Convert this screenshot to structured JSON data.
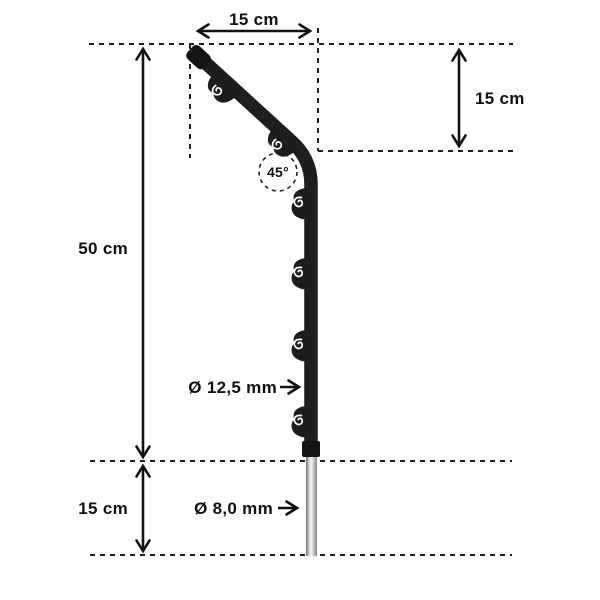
{
  "diagram": {
    "description": "Dimension drawing of an electric fence post with angled 45-degree head, wire-holder clips and ground spike",
    "labels": {
      "top_width": "15 cm",
      "head_height": "15 cm",
      "post_height": "50 cm",
      "spike_length": "15 cm",
      "post_diameter": "Ø 12,5 mm",
      "spike_diameter": "Ø 8,0 mm",
      "bend_angle": "45°"
    },
    "colors": {
      "background": "#ffffff",
      "dimension_line": "#1a1a1a",
      "text": "#111111",
      "post": "#1e1e1e",
      "spike_highlight": "#f5f5f5",
      "spike_shade": "#7a7a7a"
    }
  }
}
